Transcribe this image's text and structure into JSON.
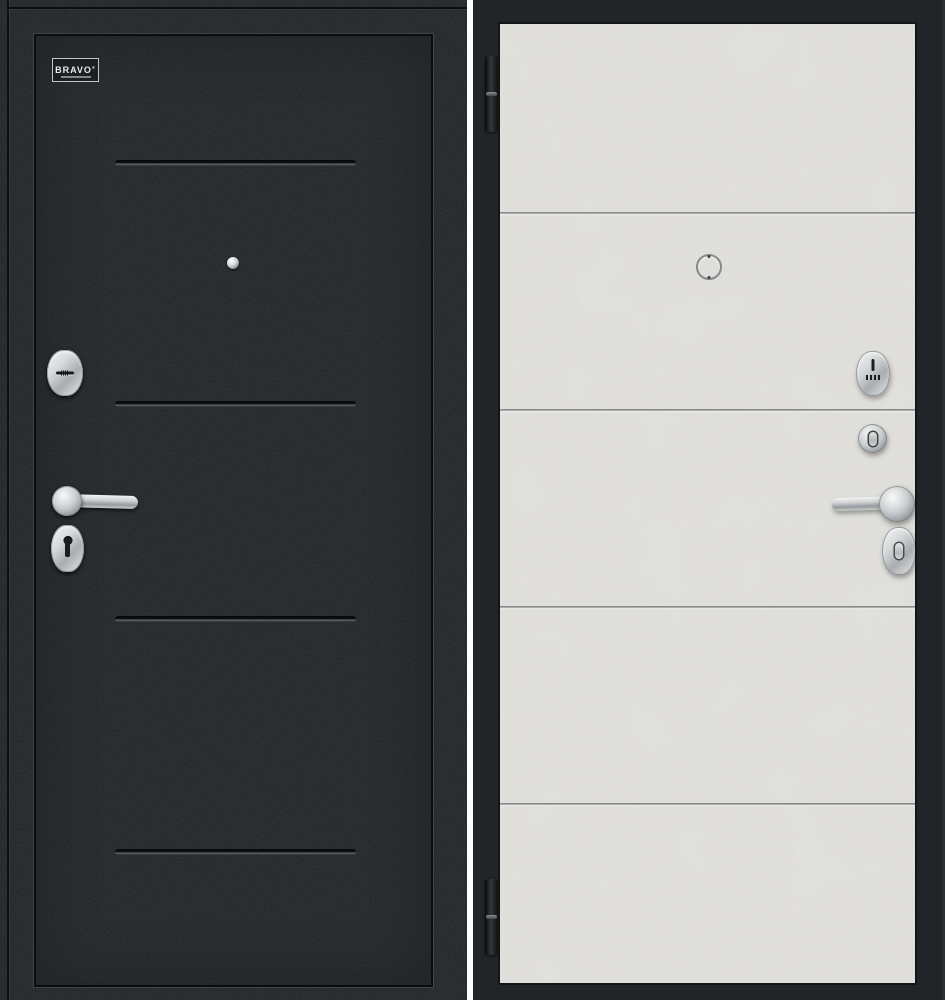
{
  "scene": {
    "subject": "steel entry door, exterior and interior sides",
    "divider_color": "#ffffff"
  },
  "exterior_door": {
    "label": "exterior black side",
    "finish_color": "#1d2023",
    "logo": {
      "text": "BRAVO",
      "mark": "®"
    },
    "groove_count": 4,
    "hardware": [
      "peephole",
      "cylinder-escutcheon",
      "lever-handle",
      "keyhole-escutcheon"
    ]
  },
  "interior_door": {
    "label": "interior light concrete side",
    "finish_color": "#e2e1dd",
    "frame_color": "#212528",
    "groove_count": 4,
    "hinge_count": 2,
    "hardware": [
      "peephole-ring",
      "thumbturn-escutcheon",
      "night-latch-knob",
      "lever-handle",
      "thumbturn-oval-escutcheon"
    ]
  },
  "colors": {
    "chrome": "#cfd2d3",
    "groove_shadow": "#0b0d0e"
  }
}
